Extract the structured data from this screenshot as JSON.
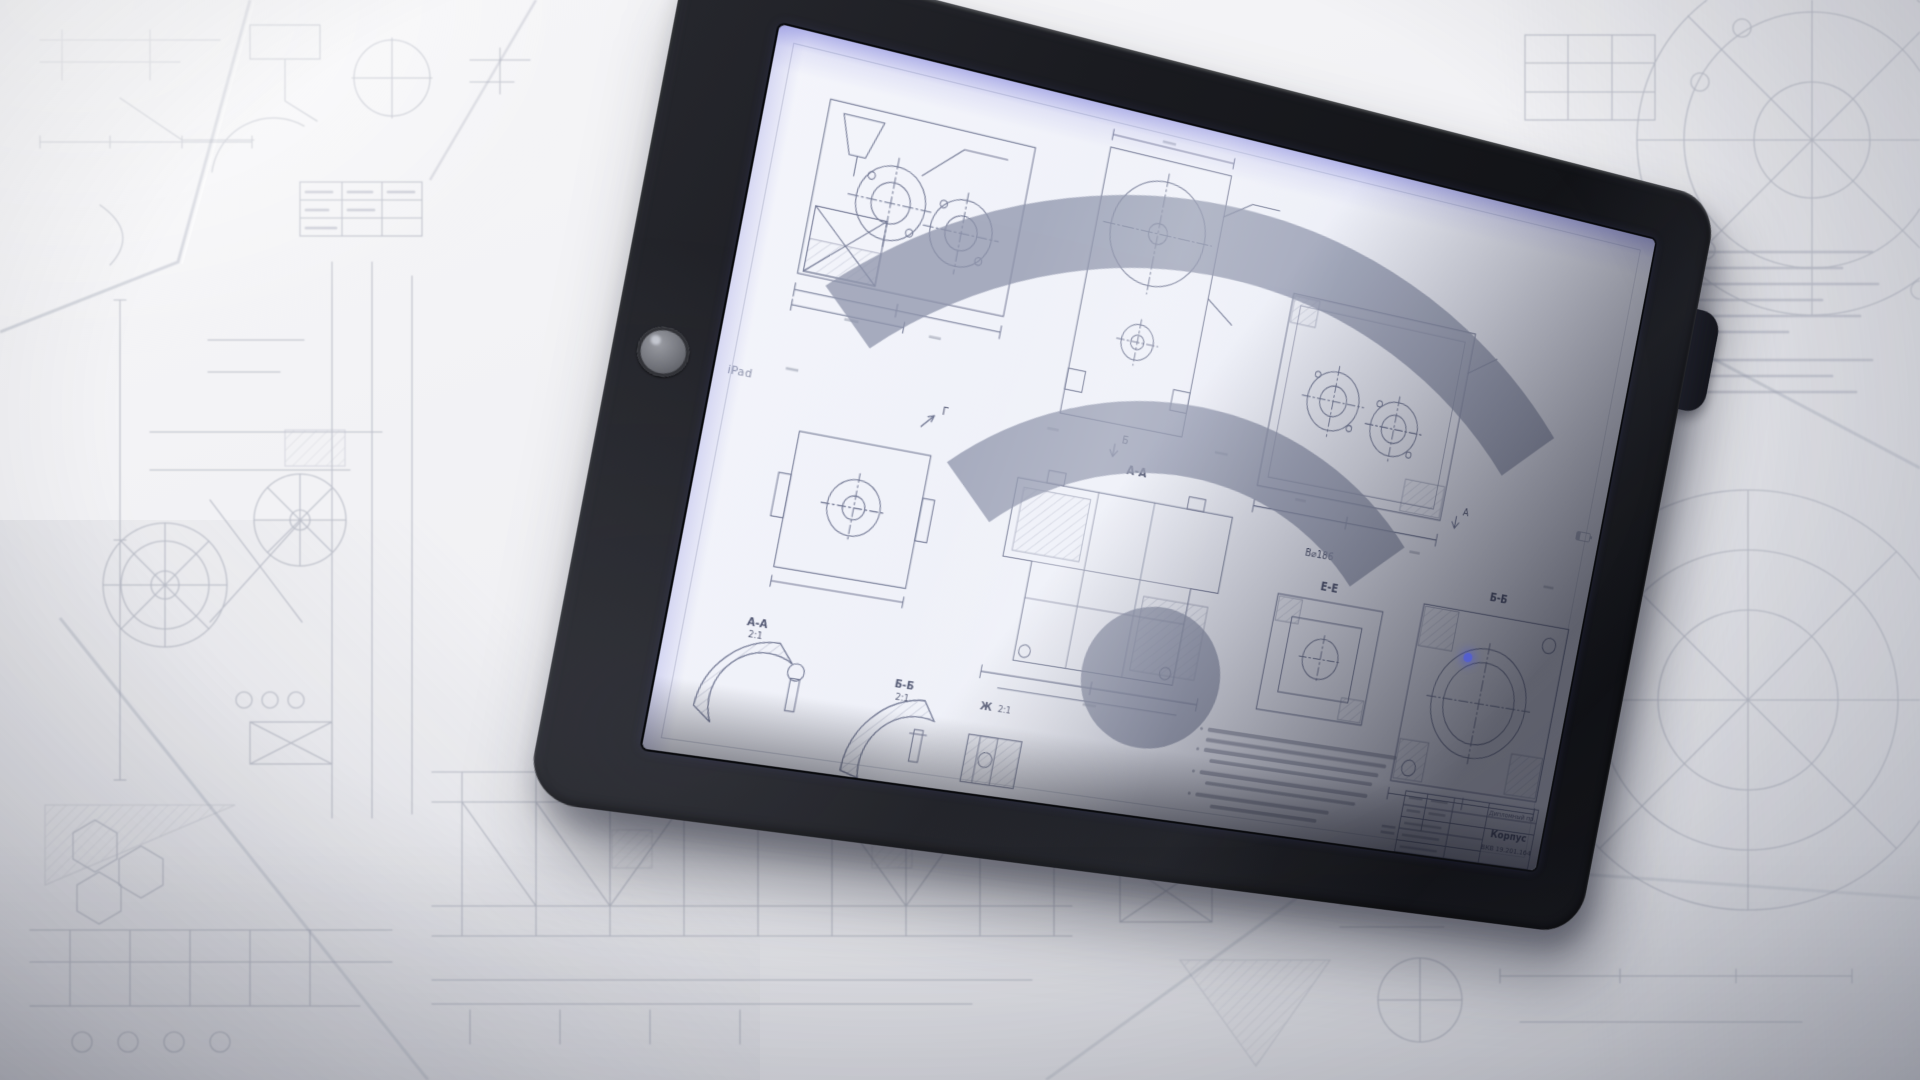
{
  "tablet": {
    "status_bar": {
      "device": "iPad"
    },
    "drawing": {
      "labels": {
        "section_aa": "А-А",
        "section_bb": "Б-Б",
        "section_ee": "Е-Е",
        "dia_note": "В⌀186",
        "detail_aa": "А-А",
        "detail_aa_scale": "2:1",
        "detail_bb": "Б-Б",
        "detail_bb_scale": "2:1",
        "detail_zh": "Ж",
        "detail_zh_scale": "2:1",
        "view_arrow_g": "Г",
        "view_arrow_b": "Б",
        "view_arrow_a": "А"
      },
      "title_block": {
        "project": "Дипломный пр.",
        "part": "Корпус",
        "number": "ВКВ 19.201.164"
      }
    }
  },
  "colors": {
    "case": "#17181c",
    "screen_paper": "#eef0f8",
    "screen_fringe": "#7274d8",
    "drawing_ink": "#5c6382",
    "background_paper": "#f2f2f4",
    "background_ink": "#8a90a1",
    "flare": "#4d5ae0"
  }
}
